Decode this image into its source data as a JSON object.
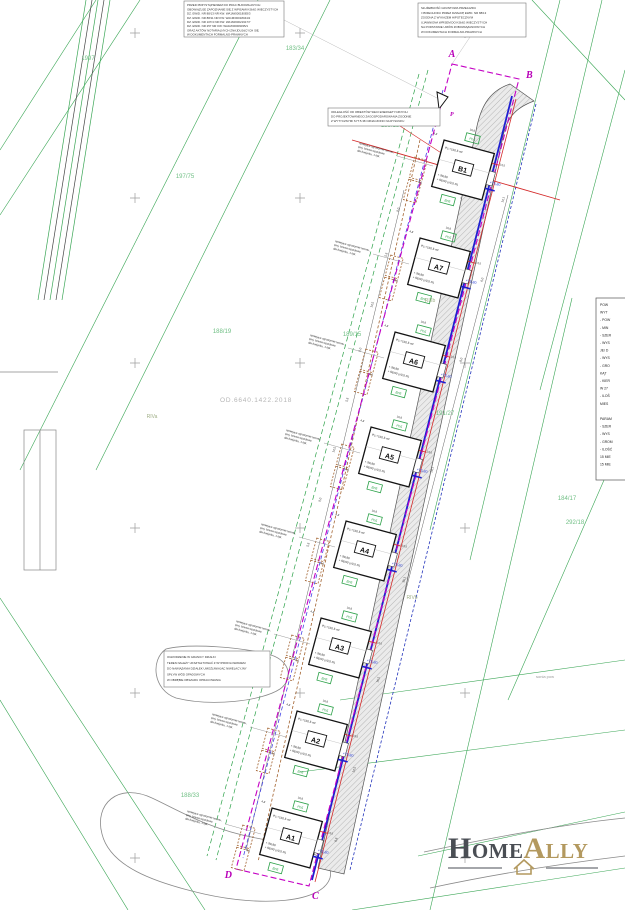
{
  "corners": {
    "a": "A",
    "b": "B",
    "c": "C",
    "d": "D"
  },
  "marker_p": "P",
  "doc_number": "OD.6640.1422.2018",
  "faint_note": "sonia pow",
  "blocks": {
    "top_left": {
      "lines": [
        "PRZED PRZYSTĄPIENIEM DO PRAC BUDOWLANYCH",
        "OBOWIĄZUJE ZAPOZNANIE SIĘ Z WPISAMI KSIĄG WIECZYSTYCH",
        "DZ. EWID. NR 88/13  NR KW:  WA1M/00018083/3",
        "DZ. EWID. NR 88/11  NR KW:  WA1M/00018044/2",
        "DZ. EWID. NR 107/4  NR KW:  WA1M/00021917/7",
        "DZ. EWID. NR 257  NR KW:  WA1M/00009035/1",
        "ORAZ AKTÓW NOTARIALNYCH ZNAJDUJĄCYCH SIĘ",
        "W DOKUMENTACH FORMALNO-PRAWNYCH"
      ]
    },
    "top_right": {
      "lines": [
        "SŁUŻEBNOŚĆ GRUNTOWA PRZEJAZDU",
        "I PRZECHODU PRZEZ DZIAŁKĘ EWID. NR 88/13",
        "ZGODNA Z WYKAZEM HIPOTECZNYM",
        "UJAWNIONA WPISEM DO KSIĄG WIECZYSTYCH",
        "NA PODSTAWIE UMÓW ZOBOWIĄZANIOWYCH",
        "W DOKUMENTACH FORMALNO-PRAWNYCH"
      ]
    },
    "mid_note": {
      "lines": [
        "ODLEGŁOŚĆ OD OBIEKTÓW SIECI ENERGETYCZNYCH",
        "DO PROJEKTOWANEGO ZAGOSPODAROWANIA ZGODNIE",
        "Z WYTYCZNYMI SYT.5.38 OZNACZONO NA RYSUNKU"
      ]
    },
    "grading_note": {
      "lines": [
        "OGRODZENIE W GRANICY DZIAŁKI",
        "TEREN NALEŻY UKSZTAŁTOWAĆ Z WYPROFILOWANIEM",
        "DO NAWIĄZANIA DZIAŁEK UMOŻLIWIAJĄC NIWELACYJNY",
        "SPŁYW WÓD OPADOWYCH",
        "W OBRĘBIE OBSZARU OPRACOWANIA"
      ]
    },
    "gate_note": {
      "lines": [
        "istniejące ogrodzenie terenu,",
        "proj. brama wjazdowa",
        "dla budynku, 1 kpl."
      ]
    }
  },
  "legend_right": {
    "lines": [
      "POW",
      "WYT",
      "- POW",
      "- MIN",
      "- SZER",
      "- WYS",
      "JE/ D",
      "- WYS",
      "- GRO",
      "KĄT",
      "- KIER",
      "W 27",
      "- ILOŚ",
      "MIES",
      "",
      "PARAM",
      "- SZER",
      "- WYS",
      "- GROM",
      "- ILOŚĆ",
      "15 MIE",
      "15 MIE"
    ]
  },
  "parcels": [
    "1997",
    "183/34",
    "189/13",
    "197/75",
    "188/19",
    "189/15",
    "191/27",
    "184/17",
    "292/18",
    "188/33"
  ],
  "soils": [
    "RIIIb",
    "RIVb",
    "RIVa"
  ],
  "dims_left": [
    "9,0",
    "5,5",
    "14,5",
    "9,0",
    "5,5",
    "14,5",
    "9,0",
    "5,5"
  ],
  "dims_right": [
    "14,1",
    "6,0",
    "8,0",
    "20,1",
    "35,1",
    "16,5",
    "14,5",
    "8,8"
  ],
  "dims_building": [
    "4,8",
    "10,8",
    "8,5",
    "14,5"
  ],
  "buildings": [
    {
      "label": "B1",
      "area": "Pz.=160,5 m²",
      "lvl1": "+ 99,80",
      "lvl2": "+ 98,50 (±0,5 m)",
      "blue": "+75,80",
      "g1": "Pn5",
      "g2": "Bn5"
    },
    {
      "label": "A7",
      "area": "Pz.=160,5 m²",
      "lvl1": "+ 99,80",
      "lvl2": "+ 98,50 (±0,5 m)",
      "blue": "+75,80",
      "g1": "Pn5",
      "g2": "Bn5"
    },
    {
      "label": "A6",
      "area": "Pz.=160,5 m²",
      "lvl1": "+ 99,80",
      "lvl2": "+ 98,50 (±0,5 m)",
      "blue": "+75,80",
      "g1": "Pn5",
      "g2": "Bn5"
    },
    {
      "label": "A5",
      "area": "Pz.=160,5 m²",
      "lvl1": "+ 99,80",
      "lvl2": "+ 98,50 (±0,5 m)",
      "blue": "+75,80",
      "g1": "Pn5",
      "g2": "Bn5"
    },
    {
      "label": "A4",
      "area": "Pz.=160,5 m²",
      "lvl1": "+ 99,80",
      "lvl2": "+ 98,50 (±0,5 m)",
      "blue": "+75,80",
      "g1": "Pn5",
      "g2": "Bn5"
    },
    {
      "label": "A3",
      "area": "Pz.=160,5 m²",
      "lvl1": "+ 99,80",
      "lvl2": "+ 98,50 (±0,5 m)",
      "blue": "+75,80",
      "g1": "Pn5",
      "g2": "Bn5"
    },
    {
      "label": "A2",
      "area": "Pz.=160,5 m²",
      "lvl1": "+ 99,80",
      "lvl2": "+ 98,50 (±0,5 m)",
      "blue": "+75,80",
      "g1": "Pn5",
      "g2": "Bn5"
    },
    {
      "label": "A1",
      "area": "Pz.=160,5 m²",
      "lvl1": "+ 99,80",
      "lvl2": "+ 98,50 (±0,5 m)",
      "blue": "+75,80",
      "g1": "Pn5",
      "g2": "Bn5"
    }
  ],
  "logo": {
    "home": "Home",
    "ally": "Ally"
  }
}
